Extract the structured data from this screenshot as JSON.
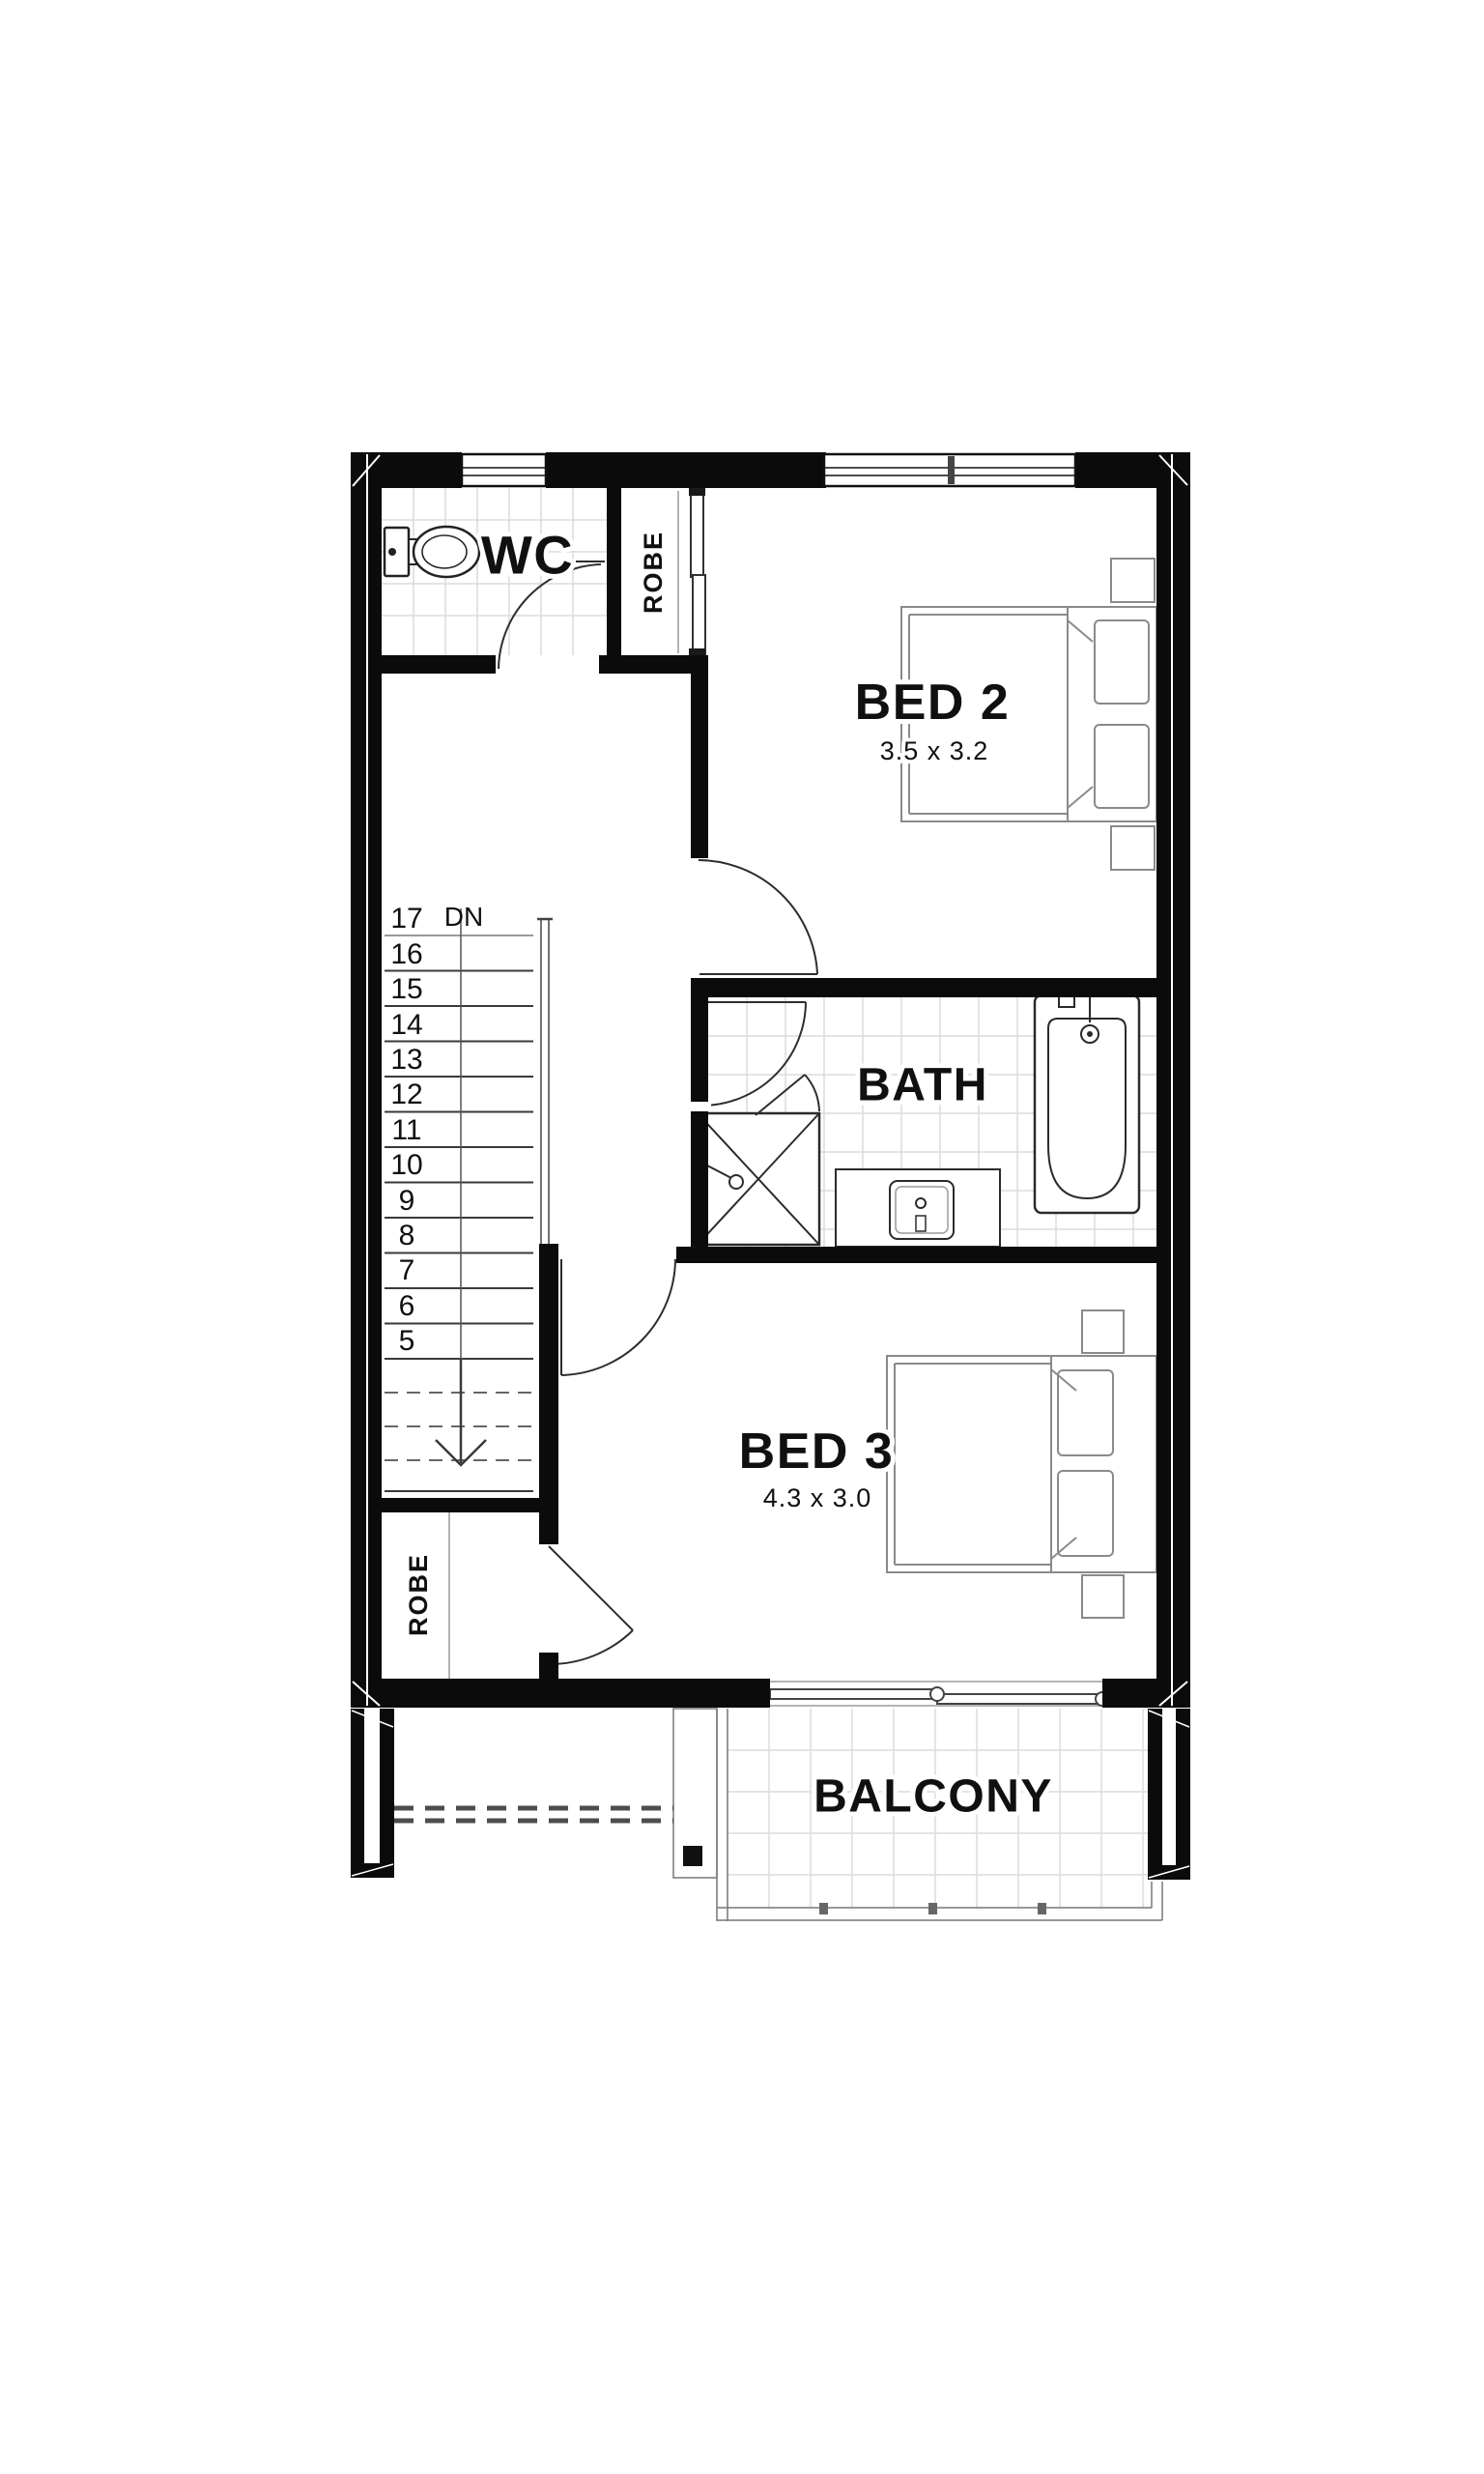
{
  "floor_plan": {
    "rooms": {
      "wc": {
        "label": "WC"
      },
      "robe_upper": {
        "label": "ROBE"
      },
      "bed2": {
        "label": "BED 2",
        "dimensions": "3.5 x 3.2"
      },
      "bath": {
        "label": "BATH"
      },
      "bed3": {
        "label": "BED 3",
        "dimensions": "4.3 x 3.0"
      },
      "robe_lower": {
        "label": "ROBE"
      },
      "balcony": {
        "label": "BALCONY"
      }
    },
    "stairs": {
      "direction_label": "DN",
      "tread_numbers": [
        "17",
        "16",
        "15",
        "14",
        "13",
        "12",
        "11",
        "10",
        "9",
        "8",
        "7",
        "6",
        "5"
      ]
    },
    "colors": {
      "wall": "#0b0b0b",
      "tile_grid": "#dcdcdc",
      "fixture_line": "#3a3a3a",
      "furniture_line": "#8a8a8a",
      "text": "#101010",
      "background": "#ffffff"
    }
  }
}
